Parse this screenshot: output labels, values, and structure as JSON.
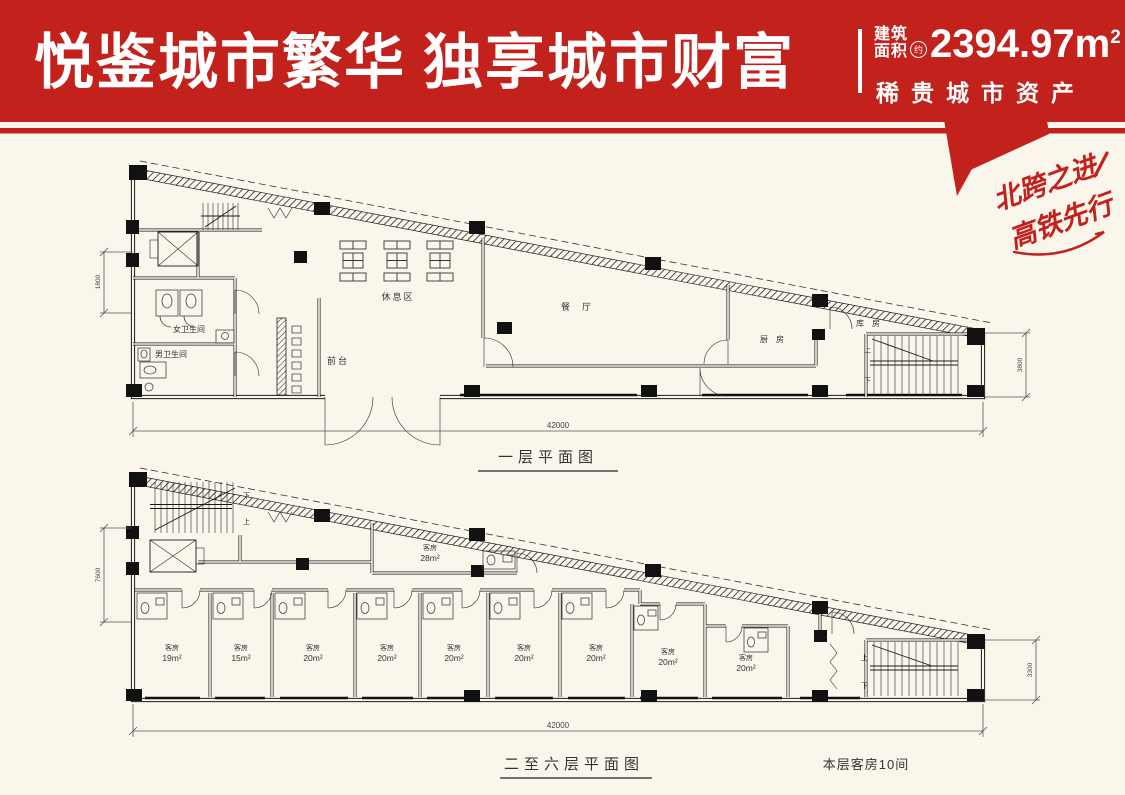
{
  "header": {
    "title": "悦鉴城市繁华 独享城市财富",
    "area_label_top": "建筑",
    "area_label_bottom": "面积",
    "area_approx": "约",
    "area_value": "2394.97",
    "area_unit": "m",
    "area_sup": "2",
    "subtitle": "稀贵城市资产",
    "accent_color": "#c3211c"
  },
  "ribbon": {
    "line1": "北跨之进",
    "line2": "高铁先行"
  },
  "floor1": {
    "title": "一层平面图",
    "dims": {
      "bottom": "42000",
      "left": "1800",
      "right": "3800"
    },
    "stair": {
      "up": "上",
      "down": "下"
    },
    "rooms": {
      "rest": "休息区",
      "dining": "餐厅",
      "kitchen": "厨房",
      "storage": "库房",
      "front_desk": "前台",
      "wc_women": "女卫生间",
      "wc_men": "男卫生间"
    }
  },
  "floor2": {
    "title": "二至六层平面图",
    "note": "本层客房10间",
    "dims": {
      "bottom": "42000",
      "left": "7600",
      "right": "3300"
    },
    "stair": {
      "up": "上",
      "下": "下",
      "down": "下"
    },
    "big_room": {
      "name": "客房",
      "area": "28m²"
    },
    "rooms": [
      {
        "name": "客房",
        "area": "19m²"
      },
      {
        "name": "客房",
        "area": "15m²"
      },
      {
        "name": "客房",
        "area": "20m²"
      },
      {
        "name": "客房",
        "area": "20m²"
      },
      {
        "name": "客房",
        "area": "20m²"
      },
      {
        "name": "客房",
        "area": "20m²"
      },
      {
        "name": "客房",
        "area": "20m²"
      },
      {
        "name": "客房",
        "area": "20m²"
      },
      {
        "name": "客房",
        "area": "20m²"
      }
    ]
  }
}
